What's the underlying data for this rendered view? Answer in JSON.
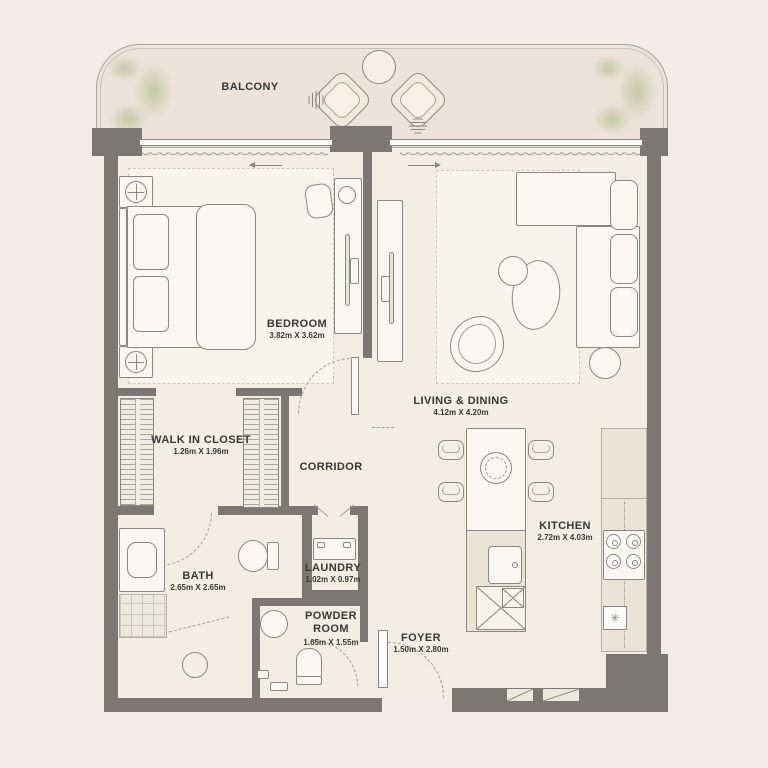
{
  "rooms": {
    "balcony": {
      "name": "BALCONY"
    },
    "bedroom": {
      "name": "BEDROOM",
      "dims": "3.82m X 3.62m"
    },
    "living_dining": {
      "name": "LIVING & DINING",
      "dims": "4.12m X 4.20m"
    },
    "walk_in_closet": {
      "name": "WALK IN CLOSET",
      "dims": "1.26m X 1.96m"
    },
    "corridor": {
      "name": "CORRIDOR"
    },
    "bath": {
      "name": "BATH",
      "dims": "2.65m X 2.65m"
    },
    "laundry": {
      "name": "LAUNDRY",
      "dims": "1.02m X 0.97m"
    },
    "powder_room": {
      "name": "POWDER ROOM",
      "dims": "1.65m X 1.55m"
    },
    "foyer": {
      "name": "FOYER",
      "dims": "1.50m X 2.80m"
    },
    "kitchen": {
      "name": "KITCHEN",
      "dims": "2.72m X 4.03m"
    }
  },
  "icons": {
    "appliance": "✳"
  },
  "colors": {
    "background": "#f2eee7",
    "floor": "#f2eee3",
    "balcony_floor": "#eee3da",
    "wall": "#7b7873",
    "line": "#8b8880",
    "plant": "#b9c49a",
    "text": "#3a3835",
    "rug": "#f7f4ec",
    "counter": "#e9e4d6",
    "furniture": "#faf8f2"
  }
}
